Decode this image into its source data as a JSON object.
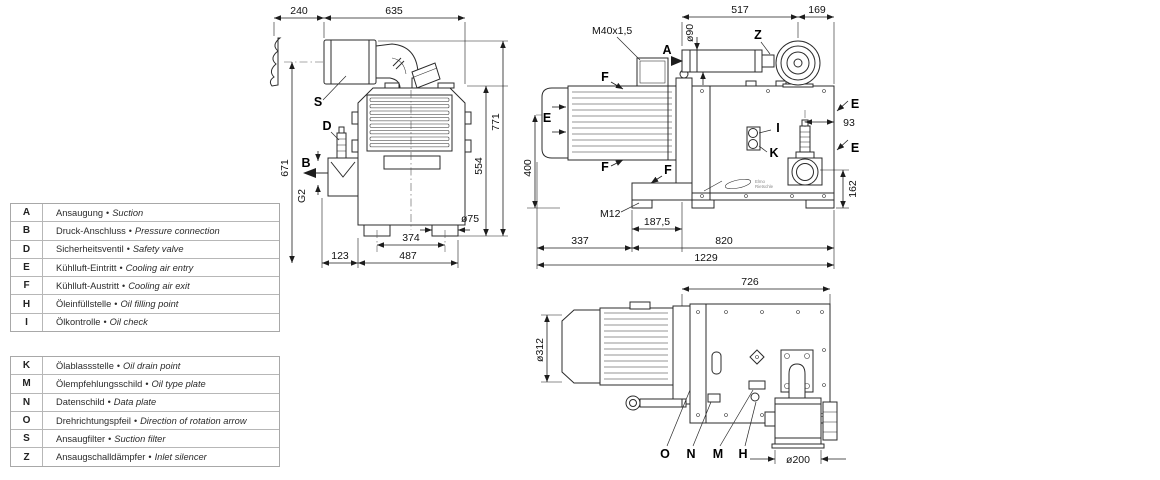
{
  "bullet": "•",
  "legend_top": {
    "rows": [
      {
        "key": "A",
        "de": "Ansaugung",
        "en": "Suction"
      },
      {
        "key": "B",
        "de": "Druck-Anschluss",
        "en": "Pressure connection"
      },
      {
        "key": "D",
        "de": "Sicherheitsventil",
        "en": "Safety valve"
      },
      {
        "key": "E",
        "de": "Kühlluft-Eintritt",
        "en": "Cooling air entry"
      },
      {
        "key": "F",
        "de": "Kühlluft-Austritt",
        "en": "Cooling air exit"
      },
      {
        "key": "H",
        "de": "Öleinfüllstelle",
        "en": "Oil filling point"
      },
      {
        "key": "I",
        "de": "Ölkontrolle",
        "en": "Oil check"
      }
    ]
  },
  "legend_bottom": {
    "rows": [
      {
        "key": "K",
        "de": "Ölablassstelle",
        "en": "Oil drain point"
      },
      {
        "key": "M",
        "de": "Ölempfehlungsschild",
        "en": "Oil type plate"
      },
      {
        "key": "N",
        "de": "Datenschild",
        "en": "Data plate"
      },
      {
        "key": "O",
        "de": "Drehrichtungspfeil",
        "en": "Direction of rotation arrow"
      },
      {
        "key": "S",
        "de": "Ansaugfilter",
        "en": "Suction filter"
      },
      {
        "key": "Z",
        "de": "Ansaugschalldämpfer",
        "en": "Inlet silencer"
      }
    ]
  },
  "front_view": {
    "d240": "240",
    "d635": "635",
    "d671": "671",
    "g2": "G2",
    "d554": "554",
    "d771": "771",
    "dia75": "ø75",
    "d374": "374",
    "d123": "123",
    "d487": "487",
    "S": "S",
    "D": "D",
    "B": "B"
  },
  "side_view": {
    "m40": "M40x1,5",
    "d517": "517",
    "d169": "169",
    "dia90": "ø90",
    "d93": "93",
    "d400": "400",
    "d162": "162",
    "m12": "M12",
    "d187_5": "187,5",
    "d337": "337",
    "d820": "820",
    "d1229": "1229",
    "A": "A",
    "Z": "Z",
    "E": "E",
    "F": "F",
    "I": "I",
    "K": "K"
  },
  "bottom_view": {
    "d726": "726",
    "dia312": "ø312",
    "dia200": "ø200",
    "O": "O",
    "N": "N",
    "M": "M",
    "H": "H"
  },
  "brand": {
    "line1": "Elmo",
    "line2": "Rietschle"
  }
}
